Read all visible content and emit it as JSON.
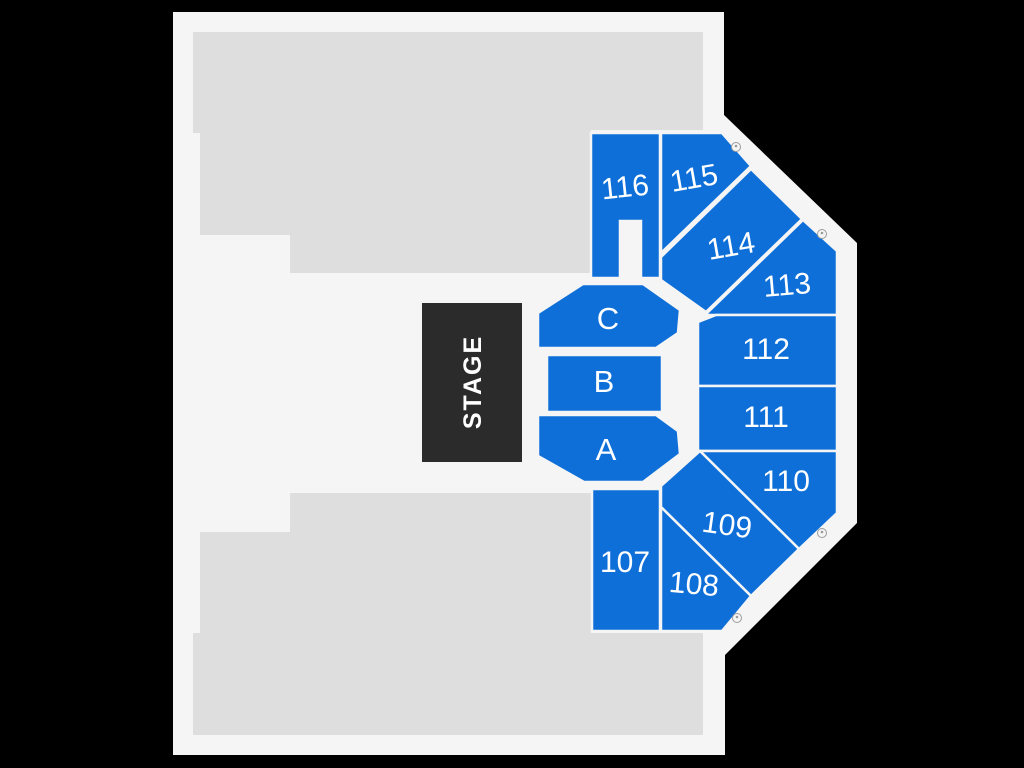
{
  "map_title": "Venue seating map",
  "colors": {
    "background": "#000000",
    "venue": "#f5f5f5",
    "unavailable": "#dedede",
    "section": "#0e6fd9",
    "stage": "#2b2b2b",
    "label": "#ffffff",
    "marker": "#9b9b9b"
  },
  "stage": {
    "label": "STAGE"
  },
  "floor_sections": [
    {
      "label": "C"
    },
    {
      "label": "B"
    },
    {
      "label": "A"
    }
  ],
  "numbered_sections": [
    {
      "label": "107"
    },
    {
      "label": "108"
    },
    {
      "label": "109"
    },
    {
      "label": "110"
    },
    {
      "label": "111"
    },
    {
      "label": "112"
    },
    {
      "label": "113"
    },
    {
      "label": "114"
    },
    {
      "label": "115"
    },
    {
      "label": "116"
    }
  ],
  "icons": {
    "accessible_marker": "wheelchair-circle-icon",
    "marker_count": 4
  }
}
